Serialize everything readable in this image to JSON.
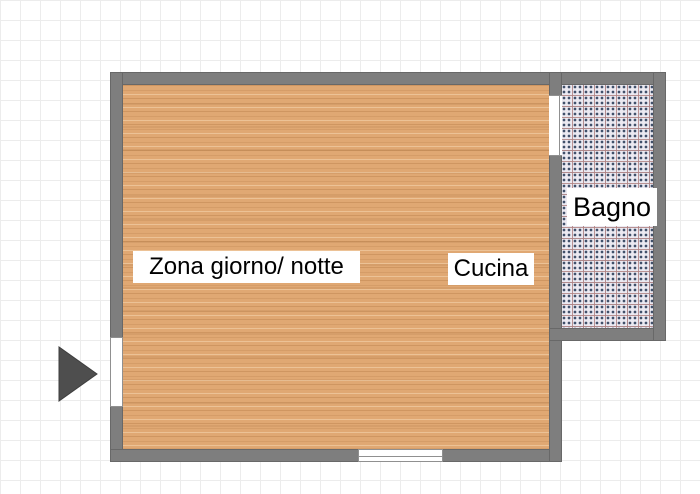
{
  "floorplan": {
    "rooms": [
      {
        "id": "zona-giorno-notte",
        "label": "Zona giorno/ notte",
        "floor": "wood"
      },
      {
        "id": "cucina",
        "label": "Cucina",
        "floor": "wood"
      },
      {
        "id": "bagno",
        "label": "Bagno",
        "floor": "tile"
      }
    ],
    "openings": [
      {
        "id": "entry-door-left",
        "wall": "left",
        "type": "door"
      },
      {
        "id": "bagno-door",
        "wall": "right-main",
        "type": "door"
      },
      {
        "id": "bottom-window",
        "wall": "bottom",
        "type": "window"
      }
    ],
    "entrance_arrow": {
      "shape": "triangle",
      "direction": "right"
    },
    "colors": {
      "wall": "#7e7e7e",
      "wall_edge": "#686868",
      "wood_floor": "#e0a873",
      "tile_base": "#ebe9f1",
      "tile_dots": "#40506a",
      "tile_grout": "#b08282",
      "grid_line": "#ececec",
      "background": "#ffffff",
      "arrow": "#4e4e4e",
      "label_bg": "#ffffff",
      "label_text": "#000000"
    }
  }
}
